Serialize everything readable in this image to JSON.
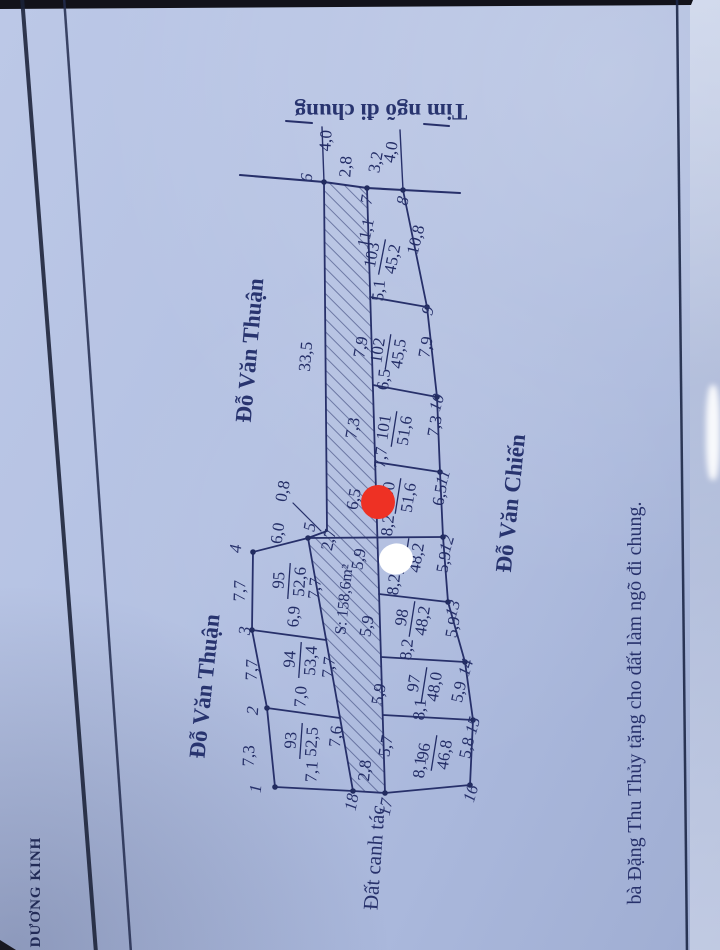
{
  "labels": {
    "lane_centerline": "Tim ngõ đi chung",
    "lane_area": "S: 158,6m²",
    "farmland": "Đất canh tác",
    "district": "DƯƠNG KINH",
    "donation_note": "bà Đặng Thu Thủy tặng cho đất làm ngõ đi chung."
  },
  "streets": {
    "thuan_upper": "Đỗ Văn Thuận",
    "thuan_lower": "Đỗ Văn Thuận",
    "chien": "Đỗ Văn Chiến"
  },
  "plots": [
    {
      "no": "93",
      "area": "52,5"
    },
    {
      "no": "94",
      "area": "53,4"
    },
    {
      "no": "95",
      "area": "52,6"
    },
    {
      "no": "96",
      "area": "46,8"
    },
    {
      "no": "97",
      "area": "48,0"
    },
    {
      "no": "98",
      "area": "48,2"
    },
    {
      "no": "99",
      "area": "48,2"
    },
    {
      "no": "100",
      "area": "51,6"
    },
    {
      "no": "101",
      "area": "51,6"
    },
    {
      "no": "102",
      "area": "45,5"
    },
    {
      "no": "103",
      "area": "45,2"
    }
  ],
  "points": [
    "1",
    "2",
    "3",
    "4",
    "5",
    "6",
    "7",
    "8",
    "9",
    "10",
    "11",
    "12",
    "13",
    "14",
    "15",
    "16",
    "17",
    "18"
  ],
  "dims": {
    "d40a": "4,0",
    "d40b": "4,0",
    "w67": "2,8",
    "w78": "3,2",
    "len6J": "33,5",
    "jog": "0,8",
    "cross": "2,7",
    "e45": "6,0",
    "l34": "7,7",
    "l23": "7,7",
    "l12": "7,3",
    "r95": "7,7",
    "r94": "7,7",
    "r93": "7,6",
    "d9594": "6,9",
    "d9493": "7,0",
    "b93": "7,1",
    "bstrip": "2,8",
    "b96": "8,1",
    "s96": "5,7",
    "d9697": "8,1",
    "s97": "5,9",
    "d9798": "8,2",
    "s98": "5,9",
    "d9899": "8,2",
    "s99": "5,9",
    "d99100": "8,2",
    "s100": "6,5",
    "d100101": "7,7",
    "s101": "7,3",
    "d101102": "6,5",
    "s102": "7,9",
    "d102103": "5,1",
    "s103": "11,1",
    "rr89": "10,8",
    "rr910": "7,9",
    "rr1011": "7,3",
    "rr1112": "6,5",
    "rr1213": "5,9",
    "rr1314": "5,9",
    "rr1415": "5,9",
    "rr1516": "5,8"
  },
  "colors": {
    "paper": "#b4c1e1",
    "ink": "#232d66",
    "red_marker": "#ee3124",
    "white_marker": "#ffffff"
  }
}
